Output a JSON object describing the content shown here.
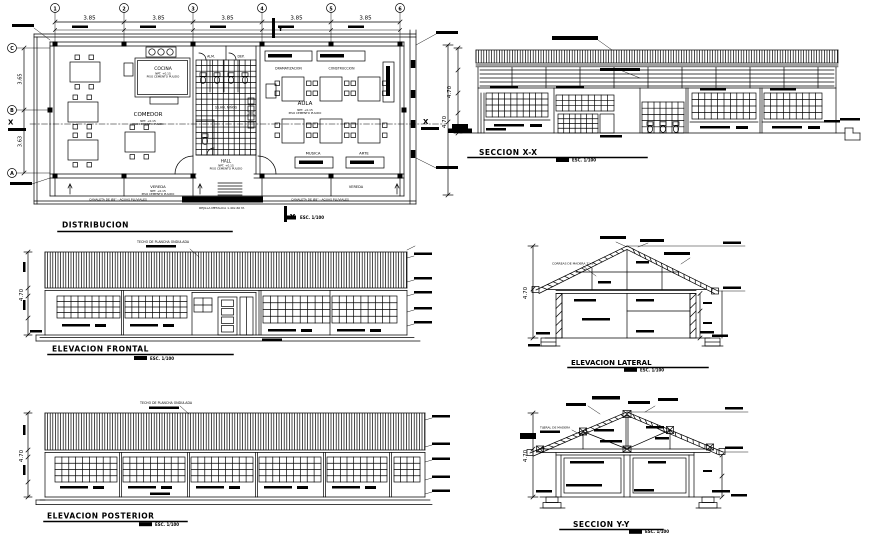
{
  "scale_label": "ESC. 1/100",
  "plan": {
    "title": "DISTRIBUCION",
    "grid_cols": [
      "1",
      "2",
      "3",
      "4",
      "5",
      "6"
    ],
    "col_dims": [
      "3.85",
      "3.85",
      "3.85",
      "3.85",
      "3.85"
    ],
    "grid_rows": [
      "C",
      "B",
      "A"
    ],
    "row_dims": [
      "3.65",
      "3.63"
    ],
    "right_dim": "4.70",
    "marker_x": "X",
    "marker_y": "Y",
    "rooms": {
      "cocina": "COCINA",
      "comedor": "COMEDOR",
      "aula": "AULA",
      "hall": "HALL",
      "musica": "MUSICA",
      "arte": "ARTE",
      "vereda": "VEREDA",
      "alm": "ALM.",
      "dep": "DEP.",
      "sshh": "SS.HH. NIÑOS",
      "dramatizacion": "DRAMATIZACION",
      "construccion": "CONSTRUCCION"
    },
    "notes": {
      "canaleta": "CANALETA DE Ø8\" - AGUAS PLUVIALES",
      "rejilla": "REJILLA METALICA 1.40x.60 M.",
      "npt": "NPT. +0.15",
      "piso": "PISO CEMENTO PULIDO"
    }
  },
  "seccion_xx": {
    "title": "SECCION X-X",
    "dim": "4.70"
  },
  "elevacion_frontal": {
    "title": "ELEVACION FRONTAL",
    "dim": "4.70",
    "roof_note": "TECHO DE PLANCHA ONDULADA"
  },
  "elevacion_lateral": {
    "title": "ELEVACION LATERAL",
    "dim": "4.70",
    "note_correas": "CORREAS DE MADERA 2\"x3\""
  },
  "elevacion_posterior": {
    "title": "ELEVACION POSTERIOR",
    "dim": "4.70",
    "roof_note": "TECHO DE PLANCHA ONDULADA"
  },
  "seccion_yy": {
    "title": "SECCION Y-Y",
    "dim": "4.70",
    "note_tijeral": "TIJERAL DE MADERA"
  }
}
